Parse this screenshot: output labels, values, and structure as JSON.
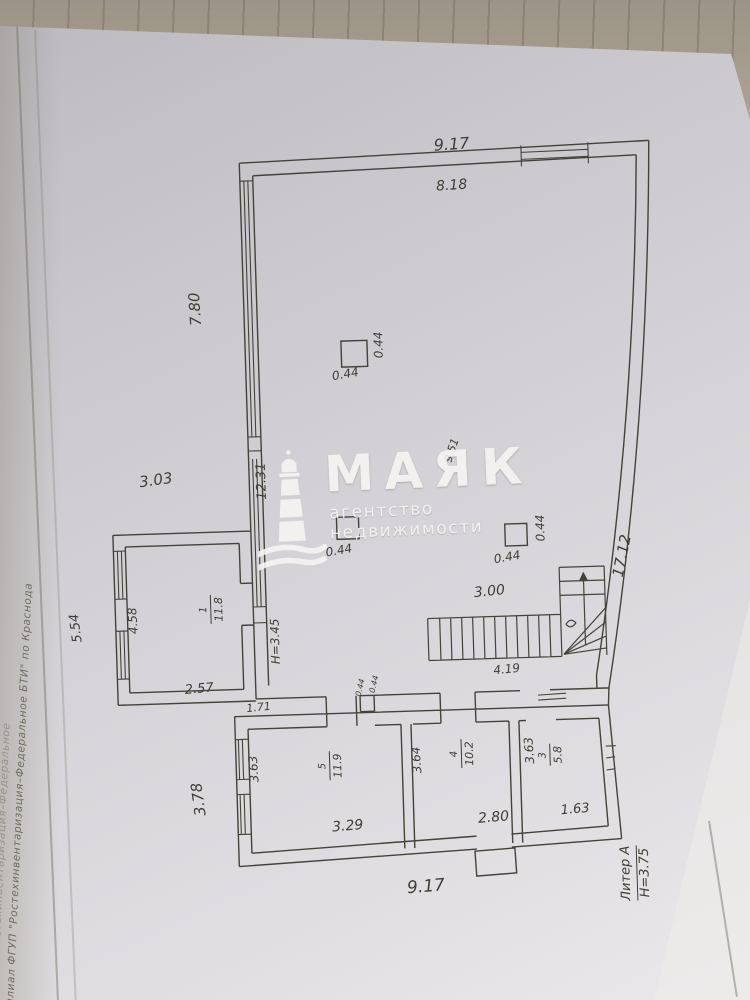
{
  "colors": {
    "background": "#aba294",
    "page": "#d6d4d8",
    "ink": "#45423a",
    "watermark": "#f7f6f3"
  },
  "watermark": {
    "title": "МАЯК",
    "subtitle": "агентство недвижимости"
  },
  "side_text": {
    "line1": "Филиал ФГУП \"Ростехинвентаризация–Федеральное БТИ\" по Краснода",
    "line2": "ал ФГУП \"Ростехинвентаризация–Федеральное"
  },
  "plan": {
    "dims": {
      "top_outer": "9.17",
      "top_inner": "8.18",
      "left_upper": "7.80",
      "left_lower": "3.03",
      "left_inner": "12.31",
      "right_side": "17.12",
      "diag": "9.51",
      "col": "0.44",
      "annex_outer": "5.54",
      "annex_inner": "4.58",
      "annex_bottom": "2.57",
      "hall_height": "Н=3.45",
      "stair_width": "3.00",
      "stair_length": "4.19",
      "wall_gap": "1.71",
      "r5_left": "3.63",
      "r5_bottom": "3.29",
      "r4_left": "3.64",
      "r4_bottom": "2.80",
      "r3_left": "3.63",
      "r3_bottom": "1.63",
      "band_left": "3.78",
      "bottom_outer": "9.17"
    },
    "rooms": {
      "annex": {
        "number": "1",
        "area": "11.8"
      },
      "room5": {
        "number": "5",
        "area": "11.9"
      },
      "room4": {
        "number": "4",
        "area": "10.2"
      },
      "room3": {
        "number": "3",
        "area": "5.8"
      }
    },
    "liter": {
      "name": "Литер А",
      "height": "Н=3.75"
    }
  }
}
